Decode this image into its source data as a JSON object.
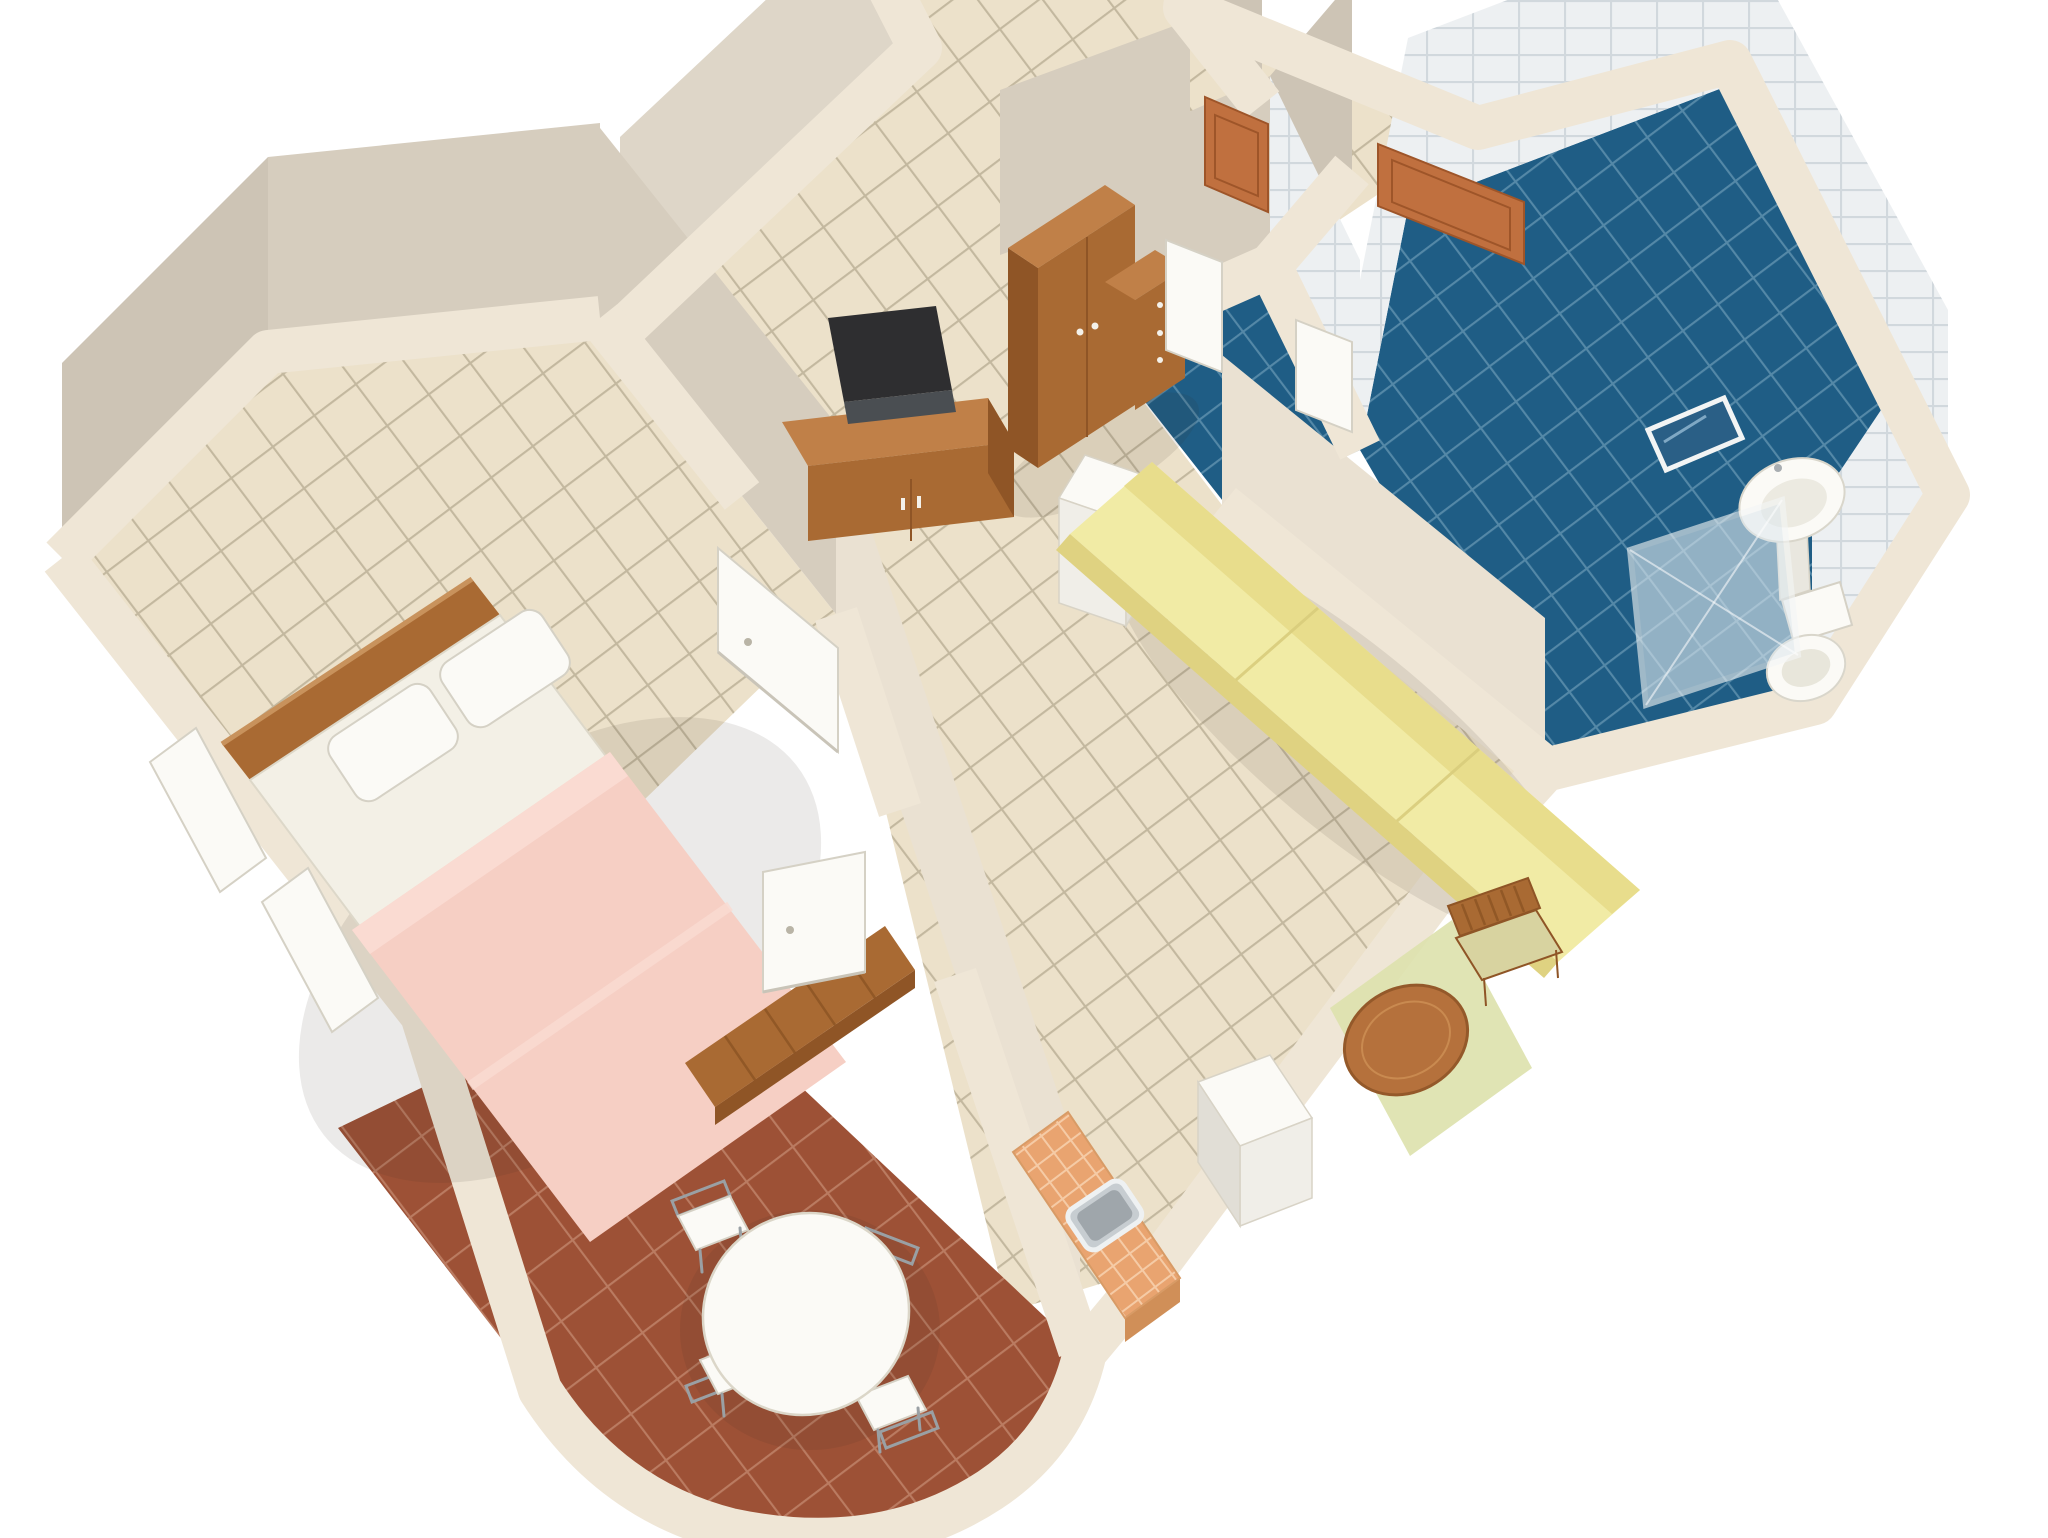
{
  "scene": {
    "description": "3D isometric cutaway render of a one-bedroom apartment floor plan on a white background",
    "background": "#ffffff",
    "view": "top-down oblique"
  },
  "palette": {
    "bg": "#ffffff",
    "wall_band": "#efe6d6",
    "face_dark": "#cdc4b5",
    "face_mid": "#d6cdbe",
    "face_light": "#ded6c8",
    "face_lit": "#eae1d2",
    "floor_beige": "#ece1ca",
    "floor_grid": "#b3a78e",
    "terracotta": "#9d5136",
    "terracotta_grid": "#c68e74",
    "bath_blue": "#1f5d85",
    "bath_grid": "#6b9ab5",
    "tile_white": "#edf0f2",
    "tile_grid": "#c5ced5",
    "kitchen_tile": "#e9a470",
    "kitchen_grid": "#f7d4b4",
    "wood": "#a96a33",
    "wood_top": "#c08048",
    "wood_dark": "#8f5526",
    "door_wood": "#c0703f",
    "door_wood_dark": "#9e5529",
    "white_obj": "#fbfaf6",
    "white_obj_shade": "#f0eee8",
    "white_obj_side": "#e1ded6",
    "sofa": "#f1eba5",
    "sofa_shade": "#dfd281",
    "sofa_back": "#e8dd8c",
    "bed_sheet": "#f3f0e6",
    "blanket": "#f6cfc4",
    "blanket_light": "#fadbd2",
    "tv_dark": "#2e2e30",
    "tv_grey": "#4a4e52",
    "rug_green": "#dde2ae",
    "table_wood": "#b5713c",
    "table_wood_dark": "#94592a",
    "mirror_blue": "#2a5f86",
    "sink_steel": "#c7cdd1",
    "sink_steel_dark": "#9fa6ab",
    "shadow": "rgba(60,50,40,0.10)"
  },
  "rooms": [
    {
      "id": "bedroom",
      "floor": "beige-tile",
      "furniture": [
        "double-bed",
        "headboard",
        "pillow",
        "pillow",
        "pink-blanket",
        "foot-bench",
        "tv-cabinet",
        "tv",
        "window-casement",
        "white-door"
      ]
    },
    {
      "id": "hallway",
      "floor": "beige-tile",
      "furniture": [
        "wardrobe",
        "drawer-chest",
        "white-column"
      ]
    },
    {
      "id": "entry",
      "floor": "beige-tile",
      "furniture": [
        "entry-door-leaf",
        "entry-door-leaf"
      ]
    },
    {
      "id": "bathroom",
      "floor": "blue-tile",
      "walls": "white-tile",
      "furniture": [
        "washbasin",
        "mirror",
        "toilet",
        "shower-enclosure",
        "white-door",
        "white-door"
      ]
    },
    {
      "id": "living-area",
      "floor": "beige-tile",
      "furniture": [
        "yellow-sofa",
        "round-table",
        "wooden-chair",
        "green-rug",
        "white-cabinet"
      ]
    },
    {
      "id": "kitchen",
      "floor": "beige-tile",
      "furniture": [
        "tiled-counter",
        "steel-sink"
      ]
    },
    {
      "id": "dining-room",
      "floor": "terracotta-tile",
      "furniture": [
        "oval-table",
        "dining-chair",
        "dining-chair",
        "dining-chair",
        "dining-chair",
        "white-door"
      ]
    }
  ]
}
